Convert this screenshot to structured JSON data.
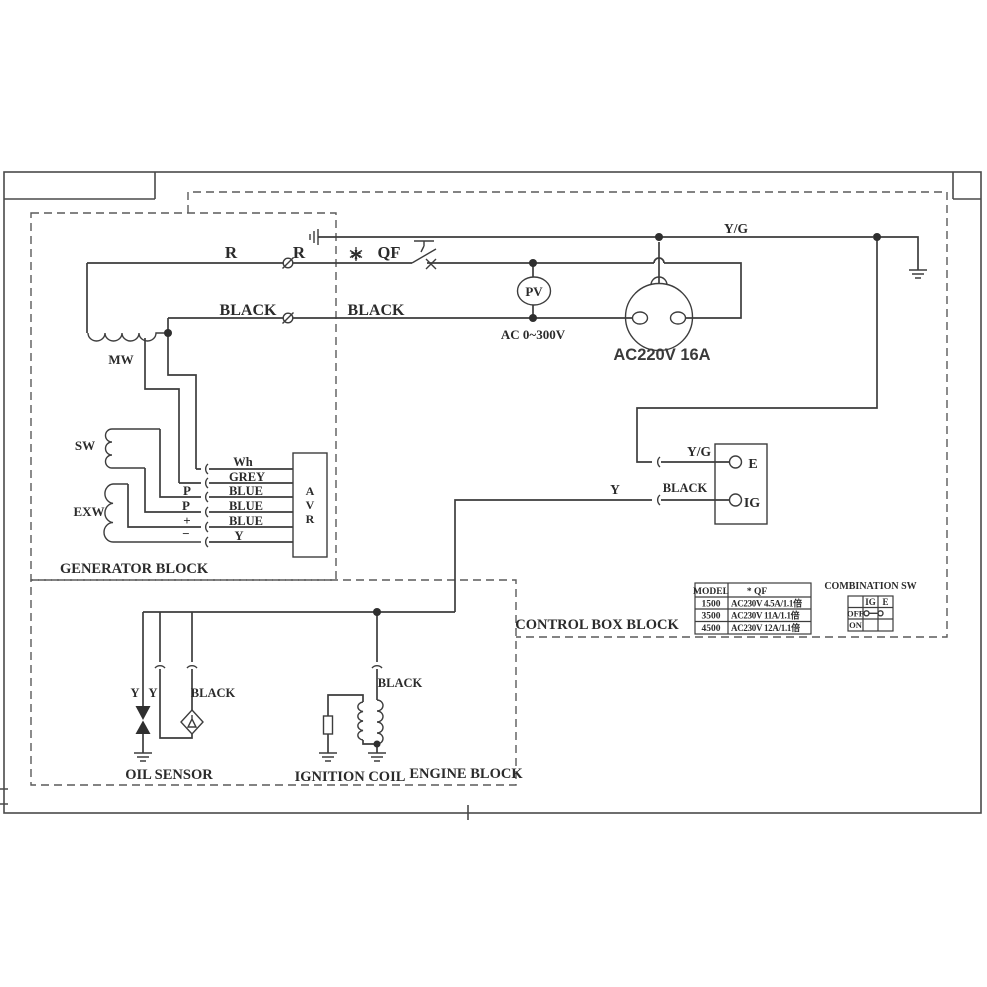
{
  "labels": {
    "r1": "R",
    "r2": "R",
    "star": "*",
    "qf": "QF",
    "black1": "BLACK",
    "black2": "BLACK",
    "yg_top": "Y/G",
    "mw": "MW",
    "sw": "SW",
    "exw": "EXW",
    "wh": "Wh",
    "grey": "GREY",
    "blue1": "BLUE",
    "blue2": "BLUE",
    "blue3": "BLUE",
    "y_avr": "Y",
    "p1": "P",
    "p2": "P",
    "plus": "+",
    "minus": "−",
    "avr_a": "A",
    "avr_v": "V",
    "avr_r": "R",
    "generator_block": "GENERATOR BLOCK",
    "pv": "PV",
    "pv_range": "AC 0~300V",
    "socket": "AC220V 16A",
    "yg_e": "Y/G",
    "terminal_e": "E",
    "y_ig": "Y",
    "black_ig": "BLACK",
    "terminal_ig": "IG",
    "control_box_block": "CONTROL BOX BLOCK",
    "y_sensor1": "Y",
    "y_sensor2": "Y",
    "black_sensor": "BLACK",
    "oil_sensor": "OIL SENSOR",
    "black_coil": "BLACK",
    "ignition_coil": "IGNITION COIL",
    "engine_block": "ENGINE BLOCK"
  },
  "model_table": {
    "headers": [
      "MODEL",
      "* QF"
    ],
    "rows": [
      [
        "1500",
        "AC230V 4.5A/1.1倍"
      ],
      [
        "3500",
        "AC230V 11A/1.1倍"
      ],
      [
        "4500",
        "AC230V 12A/1.1倍"
      ]
    ]
  },
  "combination_sw": {
    "title": "COMBINATION SW",
    "cols": [
      "IG",
      "E"
    ],
    "rows": [
      "OFF",
      "ON"
    ]
  }
}
